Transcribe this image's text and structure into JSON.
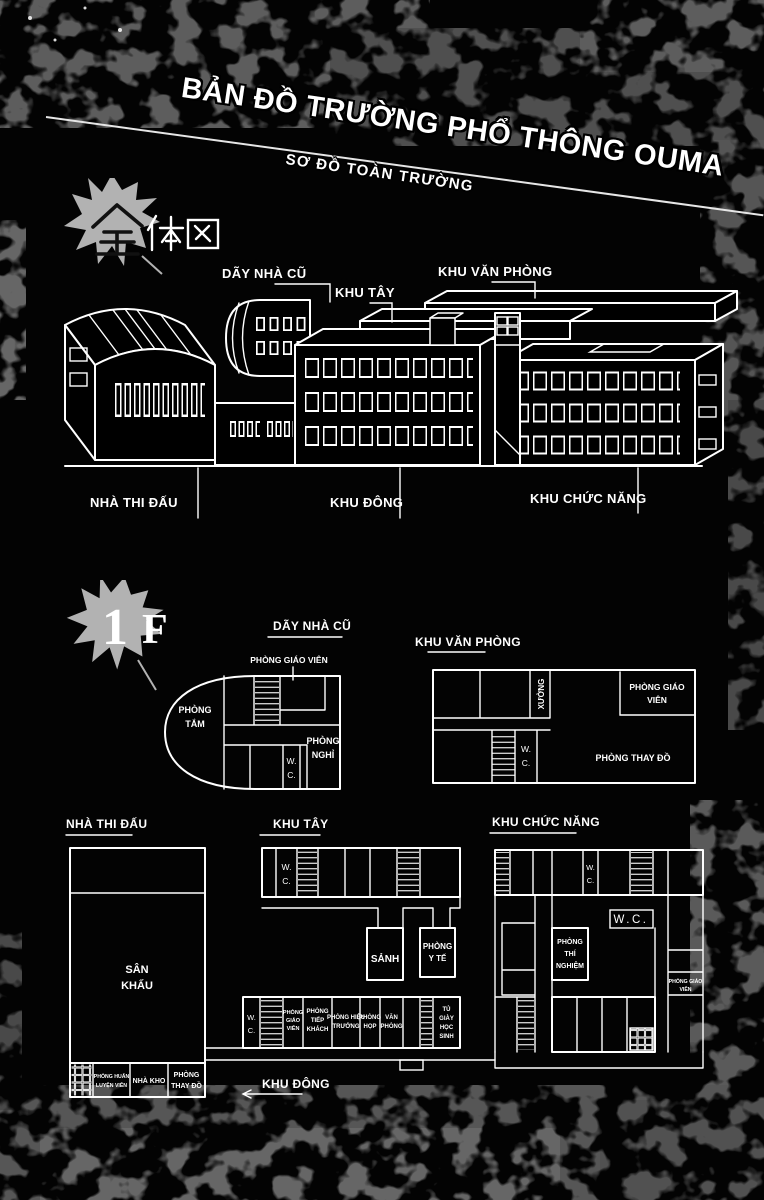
{
  "page": {
    "title": "BẢN ĐỒ TRƯỜNG PHỔ THÔNG OUMA",
    "subtitle": "SƠ ĐỒ TOÀN TRƯỜNG"
  },
  "section_overview": {
    "kanji": "全体図",
    "labels": {
      "day_nha_cu": "DÃY NHÀ CŨ",
      "khu_tay": "KHU TÂY",
      "khu_van_phong": "KHU VĂN PHÒNG",
      "nha_thi_dau": "NHÀ THI ĐẤU",
      "khu_dong": "KHU ĐÔNG",
      "khu_chuc_nang": "KHU CHỨC NĂNG"
    }
  },
  "section_floor1": {
    "floor_number": "1",
    "floor_letter": "F",
    "plan_day_nha_cu": {
      "title": "DÃY NHÀ CŨ",
      "callout": "PHÒNG GIÁO VIÊN",
      "phong_tam": [
        "PHÒNG",
        "TẮM"
      ],
      "phong_nghi": [
        "PHÒNG",
        "NGHỈ"
      ],
      "wc": [
        "W.",
        "C."
      ]
    },
    "plan_khu_van_phong": {
      "title": "KHU VĂN PHÒNG",
      "xuong": "XƯỞNG",
      "phong_giao_vien": [
        "PHÒNG GIÁO",
        "VIÊN"
      ],
      "wc": [
        "W.",
        "C."
      ],
      "phong_thay_do": "PHÒNG THAY ĐỒ"
    },
    "plan_nha_thi_dau": {
      "title": "NHÀ THI ĐẤU",
      "san_khau": [
        "SÂN",
        "KHẤU"
      ],
      "phong_huan_luyen_vien": [
        "PHÒNG HUẤN",
        "LUYỆN VIÊN"
      ],
      "nha_kho": "NHÀ KHO",
      "phong_thay_do": [
        "PHÒNG",
        "THAY ĐỒ"
      ]
    },
    "plan_khu_tay": {
      "title": "KHU TÂY",
      "wc": [
        "W.",
        "C."
      ],
      "sanh": "SẢNH",
      "phong_y_te": [
        "PHÒNG",
        "Y TẾ"
      ]
    },
    "khu_dong_wing": {
      "label": "KHU ĐÔNG",
      "wc": [
        "W.",
        "C."
      ],
      "phong_giao_vien": [
        "PHÒNG",
        "GIÁO",
        "VIÊN"
      ],
      "phong_tiep_khach": [
        "PHÒNG",
        "TIẾP",
        "KHÁCH"
      ],
      "phong_hieu_truong": [
        "PHÒNG HIỆU",
        "TRƯỞNG"
      ],
      "phong_hop": [
        "PHÒNG",
        "HỌP"
      ],
      "van_phong": [
        "VĂN",
        "PHÒNG"
      ],
      "tu_giay_hoc_sinh": [
        "TỦ",
        "GIÀY",
        "HỌC",
        "SINH"
      ]
    },
    "plan_khu_chuc_nang": {
      "title": "KHU CHỨC NĂNG",
      "wc_top": [
        "W.",
        "C."
      ],
      "wc_main": "W.C.",
      "phong_thi_nghiem": [
        "PHÒNG",
        "THÍ",
        "NGHIỆM"
      ],
      "phong_giao_vien": [
        "PHÒNG GIÁO",
        "VIÊN"
      ]
    }
  }
}
